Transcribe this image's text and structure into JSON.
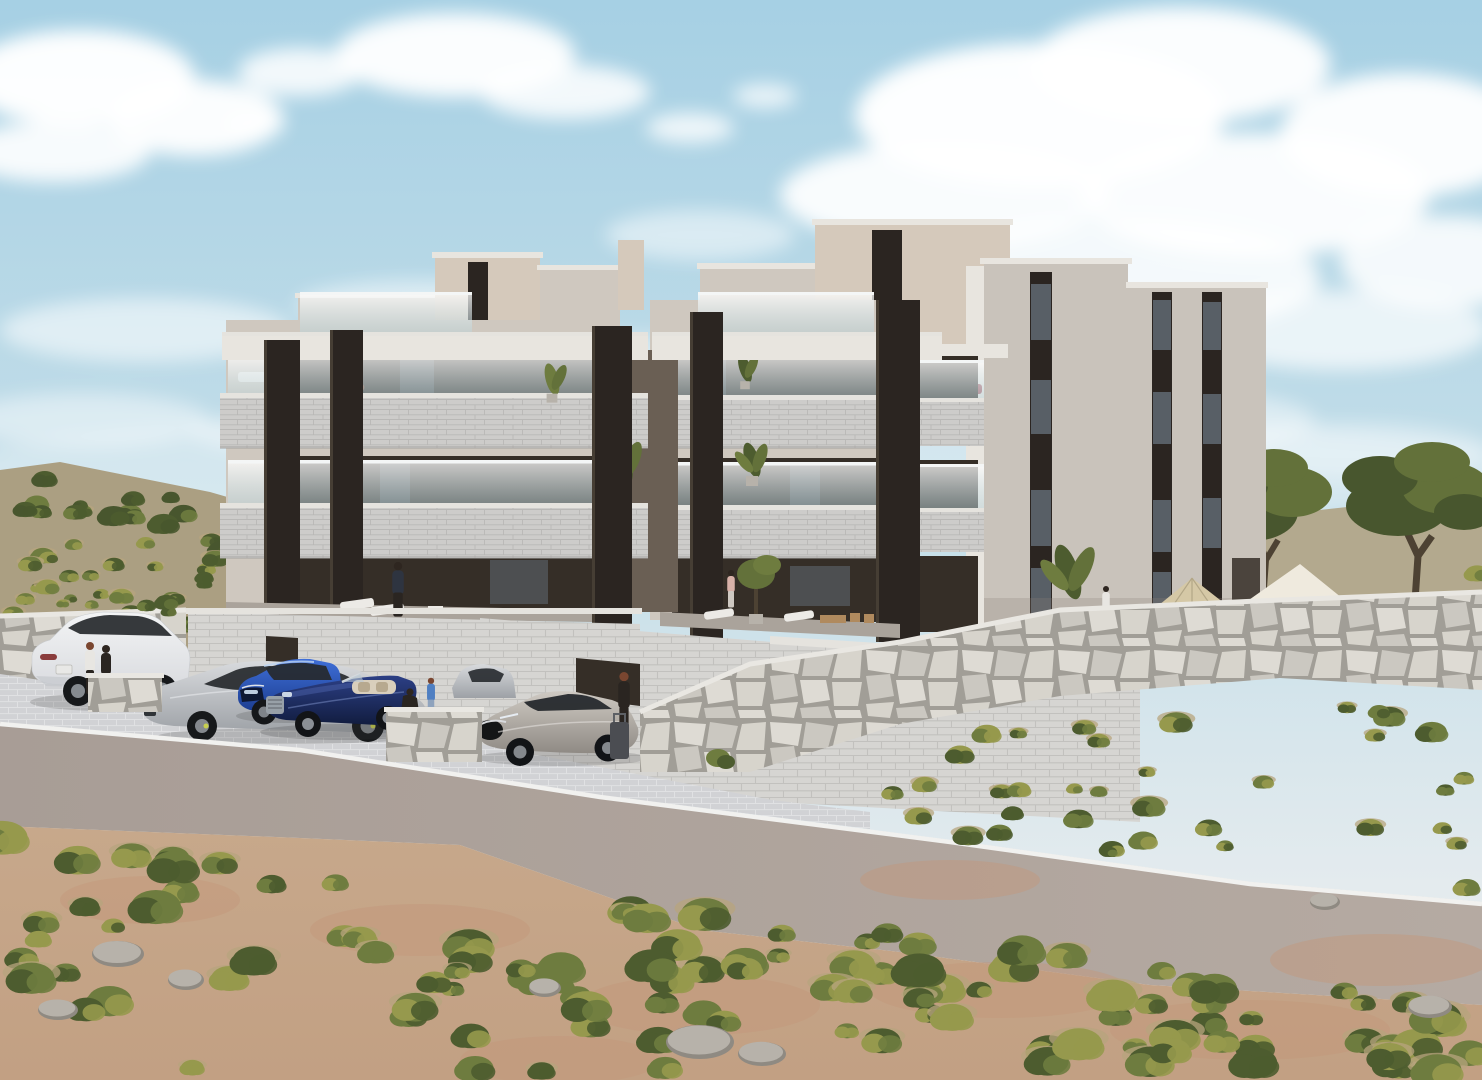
{
  "scene": {
    "type": "architectural-exterior-render",
    "setting": "modern three-storey apartment complex with dark accent pylons and glass balconies on a mediterranean scrub hillside, stone retaining walls, parking bay with five cars, asphalt road and sandy shrubland foreground under a blue sky with cumulus clouds",
    "objects": {
      "buildings": [
        "front-apartment-unit-left",
        "front-apartment-unit-right",
        "rear-penthouse-volumes",
        "side-facade-block",
        "garage-plinth"
      ],
      "vehicles": [
        {
          "name": "white-suv",
          "body": "car_white"
        },
        {
          "name": "silver-fastback-sedan",
          "body": "car_silver"
        },
        {
          "name": "blue-compact-sedan",
          "body": "car_blue"
        },
        {
          "name": "navy-convertible",
          "body": "car_navy"
        },
        {
          "name": "silver-hatchback",
          "body": "car_champagne"
        },
        {
          "name": "parked-sedan-partial",
          "body": "car_silver"
        }
      ],
      "people": [
        "two-women-by-suv",
        "man-on-ground-terrace",
        "woman-balcony-left",
        "woman-balcony-top",
        "woman-balcony-middle",
        "crouching-woman-and-child",
        "woman-with-suitcase",
        "woman-on-terrace-b",
        "woman-behind-stone-wall"
      ],
      "landscape": [
        "left-scrub-hill",
        "olive-trees",
        "patio-umbrella",
        "shade-sail",
        "stone-rubble-walls",
        "paver-parking",
        "asphalt-road",
        "foreground-scrubland",
        "rocks"
      ]
    }
  },
  "palette": {
    "sky_top": "#a6d0e4",
    "sky_mid": "#c6dfe9",
    "sky_low": "#e4ebee",
    "sky_horizon": "#edf0f0",
    "cloud": "#ffffff",
    "hill_ground": "#ab9f82",
    "hill_back": "#b3a98e",
    "facade_white": "#e8e5df",
    "facade_cream": "#d5c9bb",
    "facade_greige": "#cfc8bf",
    "facade_side": "#c9c3bb",
    "facade_gap": "#6a5f54",
    "accent_dark": "#2b2521",
    "accent_edge": "#463e34",
    "recess_dark": "#352e27",
    "recess_glass": "#5d666e",
    "recess_tan": "#8a7055",
    "slab_light": "#cdccca",
    "slab_cap": "#e5e3de",
    "slab_line": "#b9b8b6",
    "slab_shadow": "#a3a2a0",
    "glass_hi": "#ffffff",
    "glass_lo": "#bcd4da",
    "glass_rail": "#f4f6f6",
    "plinth_block": "#d6d5d2",
    "plinth_line": "#c2c1be",
    "stone_joint": "#a19e97",
    "stone_a": "#dedbd4",
    "stone_b": "#cbc8c1",
    "stone_c": "#d7d4cc",
    "stone_cap": "#e9e7e2",
    "pave": "#d1d2d5",
    "pave_line": "#e0e1e3",
    "road": "#a89d96",
    "road_light": "#b5aaa2",
    "curb": "#f1f1ef",
    "sand": "#c7a88b",
    "sand_low": "#c2a083",
    "sand_red": "#c4977a",
    "sand_pale": "#d4bfa2",
    "bush_dark": "#4d5c2f",
    "bush_mid": "#6e7c3f",
    "bush_light": "#96994d",
    "bush_dry": "#b7a47d",
    "olive_dark": "#48562e",
    "olive_mid": "#63713a",
    "trunk": "#4d4233",
    "rock": "#b7b2aa",
    "rock_shade": "#8f8a82",
    "car_white_hi": "#f3f4f5",
    "car_white_lo": "#d8dade",
    "car_silver_hi": "#d8dadd",
    "car_silver_lo": "#9da1a6",
    "car_blue_hi": "#3f6fd8",
    "car_blue_lo": "#1a3a8c",
    "car_navy_hi": "#2c3f85",
    "car_navy_lo": "#111c3e",
    "car_champ_hi": "#cfcac3",
    "car_champ_lo": "#8f8a84",
    "car_glass": "#26292d",
    "car_shadow": "#3a3a3a",
    "umbrella_tan": "#d5c8a6",
    "umbrella_pole": "#6b655e",
    "canopy_white": "#efeade",
    "skin": "#c9a089",
    "hair_dark": "#2e2620",
    "hair_auburn": "#7a4630",
    "outfit_dark": "#2a2521",
    "outfit_navy": "#2e3440",
    "outfit_white": "#e8e6e2",
    "outfit_blue": "#4f7fc2",
    "outfit_denim": "#8fa3bd",
    "outfit_pink": "#d8b1a8",
    "outfit_skirt": "#cfc9c2",
    "suitcase": "#4b4d52",
    "lounger": "#eceae6",
    "wood_chair": "#b08a5e",
    "cushion_red": "#a0505a",
    "cushion_green": "#a8ad52"
  },
  "clouds": [
    [
      80,
      78,
      115,
      48,
      0.97
    ],
    [
      195,
      118,
      88,
      38,
      0.95
    ],
    [
      55,
      152,
      95,
      30,
      0.9
    ],
    [
      300,
      72,
      62,
      24,
      0.85
    ],
    [
      255,
      125,
      30,
      11,
      0.8
    ],
    [
      455,
      55,
      120,
      42,
      0.95
    ],
    [
      565,
      92,
      85,
      27,
      0.85
    ],
    [
      690,
      128,
      44,
      15,
      0.8
    ],
    [
      765,
      96,
      32,
      12,
      0.75
    ],
    [
      1040,
      115,
      185,
      72,
      0.97
    ],
    [
      1180,
      65,
      150,
      58,
      0.95
    ],
    [
      945,
      195,
      165,
      52,
      0.92
    ],
    [
      1255,
      195,
      175,
      62,
      0.93
    ],
    [
      1115,
      278,
      205,
      58,
      0.85
    ],
    [
      1405,
      135,
      125,
      62,
      0.95
    ],
    [
      1445,
      262,
      105,
      46,
      0.85
    ],
    [
      1340,
      330,
      150,
      40,
      0.7
    ],
    [
      145,
      330,
      145,
      32,
      0.55
    ],
    [
      420,
      305,
      125,
      25,
      0.5
    ],
    [
      85,
      420,
      125,
      27,
      0.45
    ],
    [
      295,
      432,
      105,
      21,
      0.4
    ],
    [
      620,
      360,
      120,
      26,
      0.4
    ],
    [
      900,
      345,
      150,
      35,
      0.5
    ],
    [
      1150,
      420,
      165,
      32,
      0.45
    ],
    [
      700,
      235,
      95,
      25,
      0.5
    ],
    [
      480,
      420,
      130,
      24,
      0.35
    ],
    [
      1350,
      450,
      140,
      28,
      0.35
    ],
    [
      740,
      470,
      800,
      60,
      0.3
    ]
  ],
  "vegetation": {
    "regions": [
      {
        "target": "veg-hill-trees",
        "seed": 11,
        "count": 18,
        "x": [
          6,
          248
        ],
        "top": [
          468,
          498
        ],
        "bot": [
          520,
          556
        ],
        "s": [
          6,
          13
        ],
        "dry": 0.15,
        "colors": [
          "bush_dark",
          "olive_dark",
          "bush_mid"
        ]
      },
      {
        "target": "veg-hill-scrub",
        "seed": 22,
        "count": 30,
        "x": [
          0,
          250
        ],
        "top": [
          520,
          556
        ],
        "bot": [
          636,
          648
        ],
        "s": [
          5,
          11
        ],
        "dry": 0.5,
        "colors": [
          "bush_mid",
          "bush_light",
          "bush_dark"
        ]
      },
      {
        "target": "veg-under-olives",
        "seed": 33,
        "count": 12,
        "x": [
          1230,
          1478
        ],
        "top": [
          576,
          570
        ],
        "bot": [
          636,
          628
        ],
        "s": [
          7,
          13
        ],
        "dry": 0.4,
        "colors": [
          "bush_mid",
          "bush_dark",
          "bush_light"
        ]
      },
      {
        "target": "veg-terrace-left",
        "seed": 44,
        "count": 7,
        "x": [
          146,
          216
        ],
        "top": [
          574,
          578
        ],
        "bot": [
          612,
          618
        ],
        "s": [
          6,
          10
        ],
        "dry": 0.2,
        "colors": [
          "bush_mid",
          "bush_dark",
          "olive_mid"
        ]
      },
      {
        "target": "veg-right-slope",
        "seed": 55,
        "count": 36,
        "x": [
          872,
          1480
        ],
        "top": [
          740,
          694
        ],
        "bot": [
          826,
          898
        ],
        "s": [
          6,
          14
        ],
        "dry": 0.5,
        "colors": [
          "bush_mid",
          "bush_light",
          "bush_dark"
        ]
      },
      {
        "target": "veg-foreground",
        "seed": 77,
        "count": 115,
        "x": [
          0,
          1482
        ],
        "top": [
          830,
          1002
        ],
        "bot": [
          1072,
          1072
        ],
        "s": [
          9,
          22
        ],
        "dry": 0.45,
        "colors": [
          "bush_dark",
          "bush_mid",
          "bush_light"
        ]
      }
    ]
  },
  "rocks": [
    [
      118,
      952,
      26,
      13
    ],
    [
      186,
      978,
      18,
      10
    ],
    [
      545,
      986,
      16,
      9
    ],
    [
      700,
      1040,
      34,
      17
    ],
    [
      762,
      1052,
      24,
      12
    ],
    [
      1325,
      900,
      15,
      8
    ],
    [
      1430,
      1005,
      22,
      11
    ],
    [
      58,
      1008,
      20,
      10
    ]
  ],
  "sand_patches": [
    [
      150,
      900,
      90,
      24
    ],
    [
      420,
      930,
      110,
      26
    ],
    [
      700,
      1005,
      120,
      30
    ],
    [
      1000,
      990,
      130,
      28
    ],
    [
      1250,
      1030,
      140,
      30
    ],
    [
      560,
      1060,
      100,
      24
    ],
    [
      950,
      880,
      90,
      20
    ],
    [
      1380,
      960,
      110,
      26
    ]
  ]
}
